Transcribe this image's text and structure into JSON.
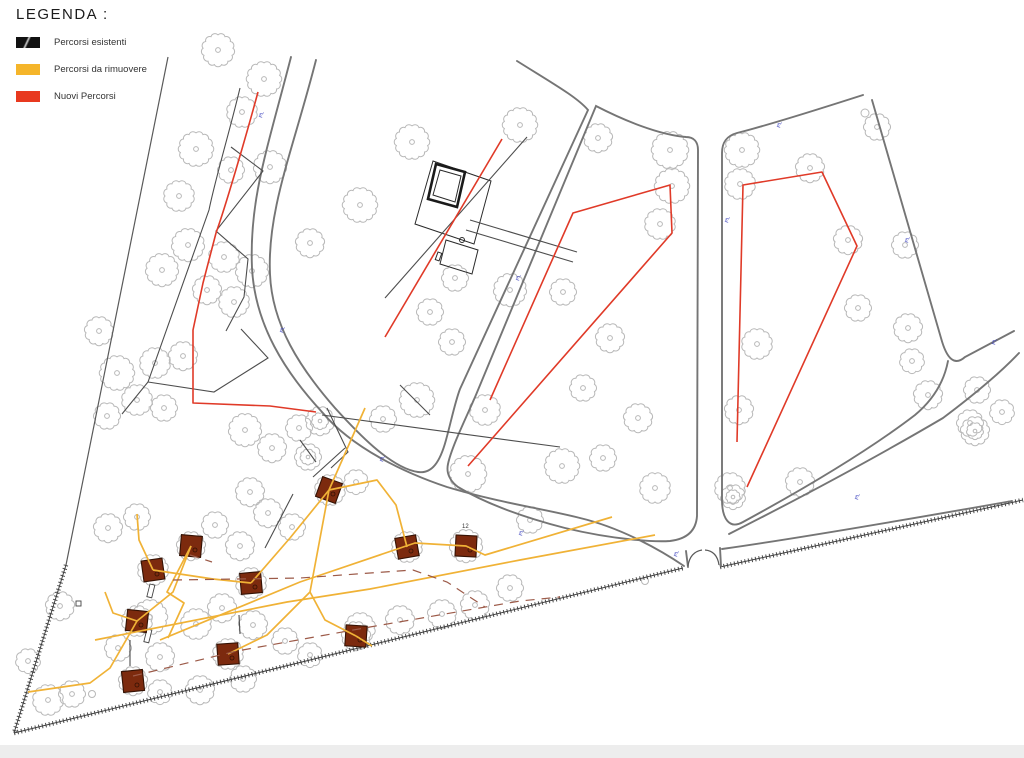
{
  "legend": {
    "title": "LEGENDA :",
    "items": [
      {
        "label": "Percorsi esistenti",
        "swatch": "black-slashed",
        "color": "#111111"
      },
      {
        "label": "Percorsi da rimuovere",
        "swatch": "yellow",
        "color": "#f5b52a"
      },
      {
        "label": "Nuovi Percorsi",
        "swatch": "red",
        "color": "#e8391f"
      }
    ]
  },
  "colors": {
    "existing_path": "#4d4d4d",
    "remove_path": "#f0b236",
    "new_path": "#e03a28",
    "road": "#757575",
    "tree": "#b8b8b8",
    "structure_fill": "#7c2a0e",
    "boundary": "#4a4a4a",
    "annotation_blue": "#3d43bf"
  },
  "annotations": {
    "tree_code": "PL",
    "plot_number": "12",
    "plot_number_pos": [
      462,
      528
    ],
    "blue_label_positions": [
      [
        262,
        118
      ],
      [
        283,
        333
      ],
      [
        519,
        281
      ],
      [
        728,
        223
      ],
      [
        780,
        128
      ],
      [
        908,
        243
      ],
      [
        995,
        345
      ],
      [
        858,
        500
      ],
      [
        677,
        557
      ],
      [
        383,
        462
      ],
      [
        522,
        536
      ]
    ]
  },
  "drawing": {
    "boundaries": [
      "M168,57 L120,296 L66,565"
    ],
    "hatched": [
      "M66,565 L14,733",
      "M14,733 L683,568",
      "M720,567 L1023,500"
    ],
    "roads": [
      "M291,57 C267,150 249,200 252,268 C255,325 285,372 322,412 C352,448 405,473 447,487 C500,503 545,509 580,518 C622,528 662,551 684,566",
      "M316,60 C293,150 267,210 270,274 C272,325 300,368 335,408 C355,430 390,468 418,472 C432,474 440,462 446,440 C451,422 455,402 460,389 L588,110 C577,97 552,83 517,61",
      "M596,106 L478,390 C470,410 452,445 448,464 C446,473 450,481 458,487 C490,506 530,519 565,528 C615,540 655,542 670,541 C687,539 696,531 697,516 L698,150 C698,142 694,137 686,137 C660,135 625,121 596,106 Z",
      "M863,95 C810,112 757,128 737,133 C726,136 722,143 722,153 L722,500 C722,518 729,530 743,522 C800,491 868,451 915,415 C933,400 944,382 948,361",
      "M872,100 C898,190 930,300 941,338 C947,360 955,366 965,357 L1014,331",
      "M729,534 C800,498 880,455 943,418 C975,394 1000,373 1019,353",
      "M722,549 C800,538 910,519 1012,501",
      "M686,551 L688,567",
      "M720,548 L721,566"
    ],
    "gate_arcs": [
      "M688,566 Q690,552 702,550",
      "M719,565 Q717,551 705,550"
    ],
    "paths_existing": [
      "M240,88 C230,130 215,180 209,210 L148,382 L122,414",
      "M231,147 L263,171 L216,231 L248,259 L244,297 L226,331",
      "M148,382 L214,392 L268,358 L241,329",
      "M327,408 L348,452 L331,468",
      "M300,440 L316,462",
      "M400,385 L430,415",
      "M345,448 L313,477",
      "M265,548 L293,494",
      "M527,137 L385,298",
      "M322,415 L560,447",
      "M470,220 L577,252",
      "M466,230 L573,262",
      "M130,640 L130,666",
      "M239,615 L240,634"
    ],
    "paths_new": [
      "M258,92 C245,140 225,208 216,233 L203,283 L193,330 L193,403 L270,406 L316,412",
      "M502,139 L385,337",
      "M490,400 L573,213 L670,185 L672,233 L468,466",
      "M737,442 L743,185 L822,172 L857,246 L747,487"
    ],
    "paths_remove": [
      "M160,640 L300,582 L415,543 L466,546 L485,555 L612,517",
      "M95,640 L287,602 L370,589 L520,560 L655,535",
      "M105,592 L113,613 L137,621 L110,668 L90,683 L28,692",
      "M137,621 L173,592 L191,546",
      "M191,546 L167,592 L184,603 L168,638",
      "M137,514 L139,540 L153,570",
      "M153,570 L213,579 L251,583",
      "M251,583 L290,538 L329,490",
      "M228,654 L267,635 L310,592 L329,490",
      "M356,636 L325,620 L310,592",
      "M356,636 L372,646",
      "M329,490 L365,408",
      "M329,490 L377,480 L396,505 L407,547"
    ],
    "paths_dashed": [
      "M133,676 L237,651 L370,627 L520,601 L560,597",
      "M173,580 L300,578 L413,570 L447,582 L485,607",
      "M190,555 L212,562"
    ],
    "trees": [
      [
        218,
        50,
        15
      ],
      [
        264,
        79,
        16
      ],
      [
        242,
        112,
        14
      ],
      [
        196,
        149,
        16
      ],
      [
        270,
        167,
        15
      ],
      [
        231,
        170,
        12
      ],
      [
        179,
        196,
        14
      ],
      [
        310,
        243,
        13
      ],
      [
        162,
        270,
        15
      ],
      [
        188,
        245,
        15
      ],
      [
        224,
        257,
        14
      ],
      [
        252,
        271,
        15
      ],
      [
        207,
        290,
        13
      ],
      [
        234,
        302,
        14
      ],
      [
        99,
        331,
        13
      ],
      [
        117,
        373,
        16
      ],
      [
        155,
        363,
        14
      ],
      [
        183,
        356,
        13
      ],
      [
        137,
        400,
        14
      ],
      [
        164,
        408,
        12
      ],
      [
        107,
        416,
        12
      ],
      [
        245,
        430,
        15
      ],
      [
        272,
        448,
        13
      ],
      [
        299,
        428,
        12
      ],
      [
        356,
        482,
        11
      ],
      [
        60,
        606,
        13
      ],
      [
        48,
        700,
        14
      ],
      [
        72,
        694,
        12
      ],
      [
        28,
        661,
        11
      ],
      [
        108,
        528,
        13
      ],
      [
        137,
        517,
        12
      ],
      [
        150,
        617,
        16
      ],
      [
        118,
        648,
        12
      ],
      [
        160,
        657,
        13
      ],
      [
        196,
        624,
        14
      ],
      [
        222,
        608,
        13
      ],
      [
        253,
        625,
        13
      ],
      [
        285,
        641,
        12
      ],
      [
        200,
        690,
        13
      ],
      [
        243,
        679,
        12
      ],
      [
        160,
        692,
        11
      ],
      [
        310,
        655,
        11
      ],
      [
        360,
        628,
        14
      ],
      [
        400,
        620,
        13
      ],
      [
        442,
        614,
        13
      ],
      [
        475,
        605,
        13
      ],
      [
        510,
        588,
        12
      ],
      [
        330,
        490,
        14
      ],
      [
        191,
        546,
        13
      ],
      [
        251,
        583,
        14
      ],
      [
        153,
        570,
        14
      ],
      [
        137,
        621,
        14
      ],
      [
        133,
        681,
        13
      ],
      [
        228,
        654,
        14
      ],
      [
        356,
        636,
        13
      ],
      [
        407,
        547,
        14
      ],
      [
        466,
        546,
        15
      ],
      [
        215,
        525,
        12
      ],
      [
        240,
        546,
        13
      ],
      [
        268,
        513,
        13
      ],
      [
        292,
        527,
        12
      ],
      [
        250,
        492,
        13
      ],
      [
        360,
        205,
        16
      ],
      [
        412,
        142,
        16
      ],
      [
        520,
        125,
        16
      ],
      [
        510,
        290,
        15
      ],
      [
        455,
        278,
        12
      ],
      [
        430,
        312,
        12
      ],
      [
        452,
        342,
        12
      ],
      [
        417,
        400,
        16
      ],
      [
        383,
        419,
        12
      ],
      [
        485,
        410,
        14
      ],
      [
        598,
        138,
        13
      ],
      [
        670,
        150,
        17
      ],
      [
        672,
        186,
        16
      ],
      [
        660,
        224,
        14
      ],
      [
        563,
        292,
        12
      ],
      [
        610,
        338,
        13
      ],
      [
        583,
        388,
        12
      ],
      [
        638,
        418,
        13
      ],
      [
        603,
        458,
        12
      ],
      [
        562,
        466,
        16
      ],
      [
        468,
        474,
        17
      ],
      [
        530,
        520,
        12
      ],
      [
        655,
        488,
        14
      ],
      [
        730,
        488,
        14
      ],
      [
        742,
        150,
        16
      ],
      [
        740,
        184,
        14
      ],
      [
        810,
        168,
        13
      ],
      [
        848,
        240,
        13
      ],
      [
        757,
        344,
        14
      ],
      [
        739,
        410,
        13
      ],
      [
        800,
        482,
        13
      ],
      [
        858,
        308,
        12
      ],
      [
        877,
        127,
        12
      ],
      [
        905,
        245,
        12
      ],
      [
        908,
        328,
        13
      ],
      [
        912,
        361,
        11
      ],
      [
        928,
        395,
        13
      ],
      [
        977,
        390,
        12
      ],
      [
        970,
        423,
        12
      ],
      [
        1002,
        412,
        11
      ]
    ],
    "dense_trees": [
      [
        320,
        421,
        13
      ],
      [
        308,
        457,
        12
      ],
      [
        975,
        431,
        13
      ],
      [
        733,
        497,
        11
      ]
    ],
    "small_circles": [
      [
        865,
        113,
        4
      ],
      [
        645,
        581,
        3.5
      ],
      [
        92,
        694,
        3.5
      ]
    ],
    "squares": [
      [
        153,
        570,
        -8
      ],
      [
        191,
        546,
        5
      ],
      [
        251,
        583,
        -5
      ],
      [
        329,
        490,
        20
      ],
      [
        407,
        547,
        -10
      ],
      [
        466,
        546,
        3
      ],
      [
        137,
        621,
        6
      ],
      [
        228,
        654,
        -4
      ],
      [
        356,
        636,
        4
      ],
      [
        133,
        681,
        -6
      ]
    ],
    "square_size": 21,
    "building": {
      "outer": [
        "433,161 491,181 474,244 415,224",
        "446,240 478,250 472,274 440,264"
      ],
      "inner_thick": "436,164 465,172 457,207 428,199",
      "inner_thin": "440,170 461,176 455,202 433,195",
      "small_circle": [
        462,
        240,
        2.5
      ],
      "small_rect": [
        438,
        252,
        4,
        8,
        20
      ]
    },
    "wall_marks": [
      [
        150,
        584,
        5,
        13,
        14
      ],
      [
        147,
        629,
        5,
        13,
        14
      ],
      [
        76,
        601,
        5,
        5,
        0
      ]
    ]
  }
}
